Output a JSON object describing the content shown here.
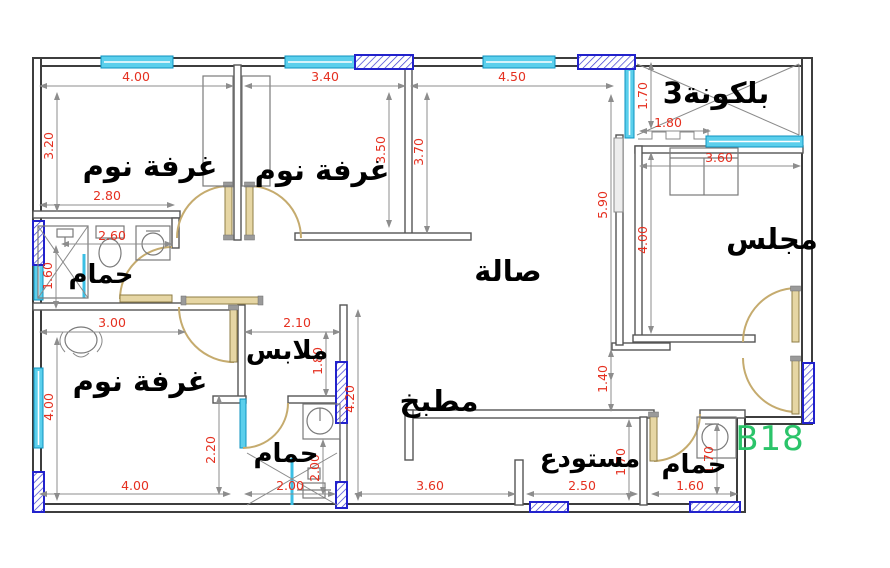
{
  "unit": {
    "number": "B18"
  },
  "rooms": {
    "bedroom_top_left": "غرفة نوم",
    "bedroom_top_middle": "غرفة نوم",
    "bedroom_bottom_left": "غرفة نوم",
    "hall": "صالة",
    "majlis": "مجلس",
    "balcony": "بلكونة3",
    "bathroom_top_left": "حمام",
    "bathroom_bottom_middle": "حمام",
    "bathroom_bottom_right": "حمام",
    "closet": "ملابس",
    "kitchen": "مطبخ",
    "storage": "مستودع"
  },
  "dimensions": {
    "bedroom1_width": "4.00",
    "bedroom2_width": "3.40",
    "hall_top_width": "4.50",
    "balcony_depth": "1.70",
    "entry_step_width": "1.80",
    "majlis_width": "3.60",
    "hall_length": "5.90",
    "majlis_length": "4.00",
    "bedroom1_left_height": "3.20",
    "bedroom2_height": "3.50",
    "bedroom2_right_height": "3.70",
    "bath1_top_width": "2.80",
    "bath1_width": "2.60",
    "bath1_height": "1.60",
    "bedroom3_top_width": "3.00",
    "bedroom3_left_height": "4.00",
    "bedroom3_bottom_width": "4.00",
    "bath2_left_height": "2.20",
    "closet_width": "2.10",
    "closet_height": "1.80",
    "bath2_inner_height": "2.00",
    "bath2_bottom_width": "2.00",
    "kitchen_height": "4.20",
    "kitchen_bottom_width": "3.60",
    "storage_bottom_width": "2.50",
    "bath3_bottom_width": "1.60",
    "storage_height": "1.70",
    "hall_kitchen_gap": "1.40",
    "bath3_height": "1.70"
  },
  "colors": {
    "dimension_text": "#e53020",
    "room_label": "#000000",
    "unit_label": "#2bc46a",
    "window_glass": "#5bcfec",
    "window_frame_blue": "#2222cc",
    "door": "#c5ab6e",
    "wall": "#4a4a4a"
  }
}
